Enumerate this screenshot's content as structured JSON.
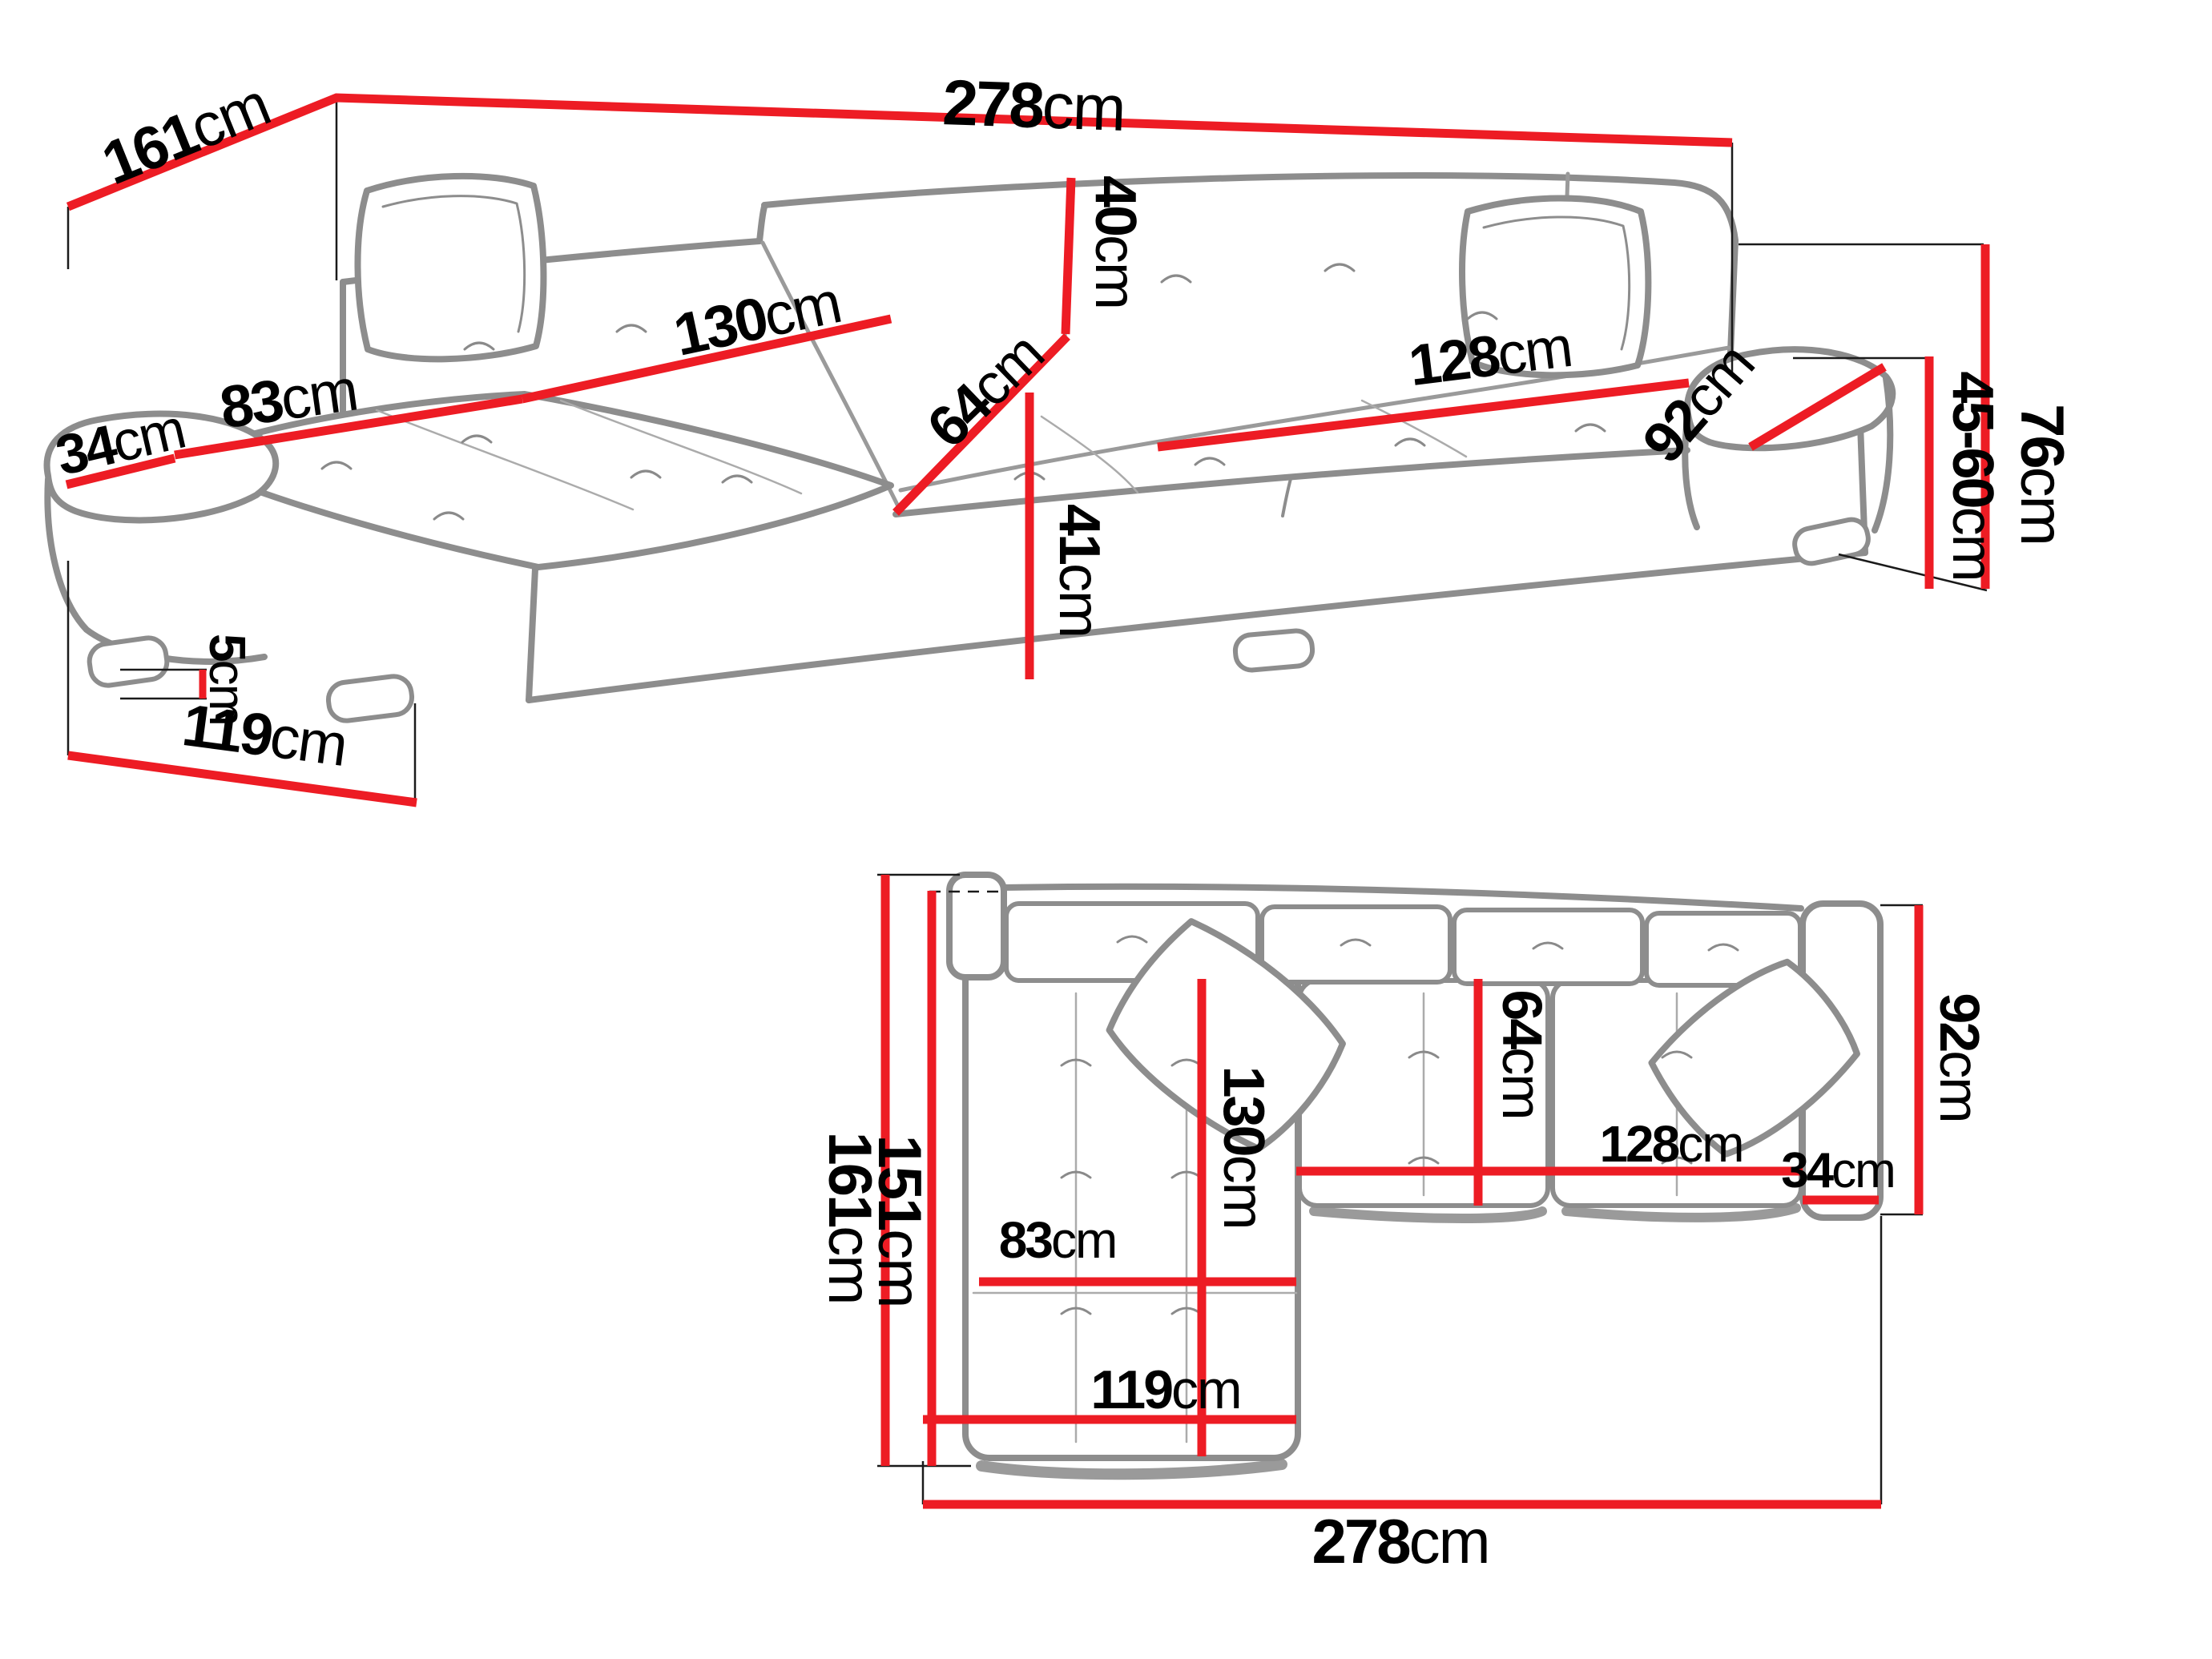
{
  "title": "Corner sofa dimension diagram (two views: perspective and top plan)",
  "colors": {
    "dimension_line": "#ed1c24",
    "sofa_outline": "#8d8d8d",
    "sofa_detail": "#a8a8a8",
    "extension_line": "#1a1a1a",
    "text": "#000000",
    "background": "#ffffff"
  },
  "views": {
    "perspective": {
      "name": "Perspective view of corner sofa",
      "dims": {
        "total_width": {
          "num": "278",
          "unit": "cm"
        },
        "total_depth": {
          "num": "161",
          "unit": "cm"
        },
        "arm_width": {
          "num": "34",
          "unit": "cm"
        },
        "chaise_cushion_width": {
          "num": "83",
          "unit": "cm"
        },
        "chaise_cushion_length": {
          "num": "130",
          "unit": "cm"
        },
        "backrest_height": {
          "num": "40",
          "unit": "cm"
        },
        "seat_depth": {
          "num": "64",
          "unit": "cm"
        },
        "seat_height": {
          "num": "41",
          "unit": "cm"
        },
        "seat_width": {
          "num": "128",
          "unit": "cm"
        },
        "arm_length": {
          "num": "92",
          "unit": "cm"
        },
        "total_height": {
          "num": "76",
          "unit": "cm"
        },
        "arm_height_range": {
          "num": "45-60",
          "unit": "cm"
        },
        "leg_height": {
          "num": "5",
          "unit": "cm"
        },
        "chaise_front_length": {
          "num": "119",
          "unit": "cm"
        }
      }
    },
    "plan": {
      "name": "Top (plan) view of corner sofa",
      "dims": {
        "total_depth": {
          "num": "161",
          "unit": "cm"
        },
        "inner_depth": {
          "num": "151",
          "unit": "cm"
        },
        "chaise_cushion_length": {
          "num": "130",
          "unit": "cm"
        },
        "chaise_cushion_width": {
          "num": "83",
          "unit": "cm"
        },
        "chaise_front_length": {
          "num": "119",
          "unit": "cm"
        },
        "total_width": {
          "num": "278",
          "unit": "cm"
        },
        "seat_depth": {
          "num": "64",
          "unit": "cm"
        },
        "seat_width": {
          "num": "128",
          "unit": "cm"
        },
        "arm_width": {
          "num": "34",
          "unit": "cm"
        },
        "arm_length": {
          "num": "92",
          "unit": "cm"
        }
      }
    }
  }
}
